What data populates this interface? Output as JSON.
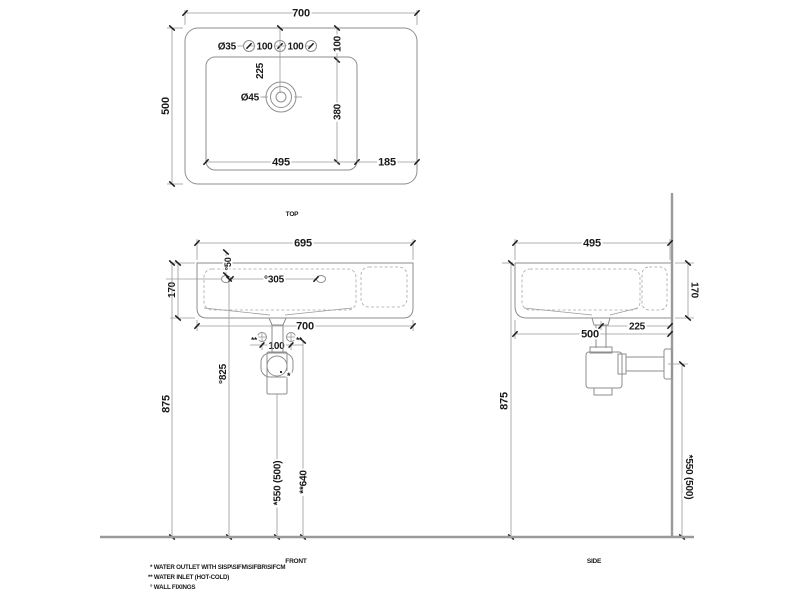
{
  "colors": {
    "object_line": "#8e8e8e",
    "dimension_line": "#9a9a9a",
    "text": "#1a1a1a",
    "background": "#ffffff"
  },
  "top_view": {
    "label": "TOP",
    "dim_width": "700",
    "dim_depth": "500",
    "dim_tap_hole_dia": "Ø35",
    "dim_tap_spacing_left": "100",
    "dim_tap_spacing_right": "100",
    "dim_tap_edge_offset": "100",
    "dim_drain_offset": "225",
    "dim_drain_dia": "Ø45",
    "dim_basin_depth": "380",
    "dim_basin_width": "495",
    "dim_ledge_width": "185"
  },
  "front_view": {
    "label": "FRONT",
    "dim_rim_width": "695",
    "dim_height": "170",
    "dim_fixing_offset": "°50",
    "dim_fixing_spacing": "°305",
    "dim_overall_width": "700",
    "inlet_mark_left": "**",
    "dim_inlet_spacing": "100",
    "inlet_mark_right": "**",
    "outlet_mark": "*",
    "dim_rim_height": "875",
    "dim_fixing_height": "°825",
    "dim_outlet_height": "*550 (500)",
    "dim_inlet_height": "**640"
  },
  "side_view": {
    "label": "SIDE",
    "dim_depth": "495",
    "dim_height": "170",
    "dim_outlet_wall_offset": "225",
    "dim_overall_depth": "500",
    "dim_rim_height": "875",
    "dim_outlet_height": "*550 (500)"
  },
  "notes": {
    "outlet": "*  WATER OUTLET WITH SISP\\SIFM\\SIFBR\\SIFCM",
    "inlet": "** WATER INLET  (HOT-COLD)",
    "fixings": "° WALL FIXINGS"
  }
}
